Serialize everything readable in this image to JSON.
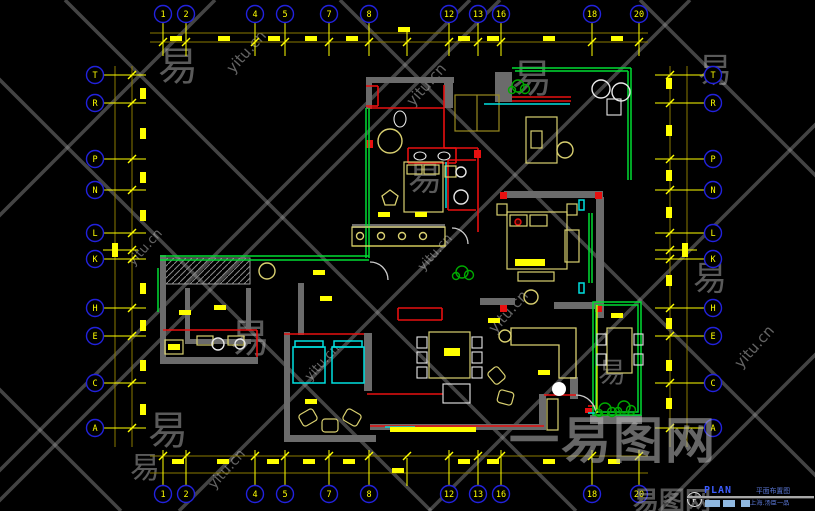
{
  "app": {
    "background": "#000000",
    "canvas": "CAD floor plan viewport"
  },
  "colors": {
    "grid_bubble": "#2222dd",
    "grid_label": "#ffff00",
    "dim_line": "#8a7a00",
    "tick": "#ffff00",
    "wall": "#6b6b6b",
    "red": "#e81010",
    "green": "#00dd33",
    "cyan": "#00e0e0",
    "furniture": "#d9d070",
    "white": "#e8e8e8",
    "watermark": "#9c9c9c",
    "title_accent": "#3c5cff",
    "title_cn": "#5b79d8"
  },
  "grid": {
    "top": {
      "cy": 14,
      "l1": 33,
      "l2": 42,
      "x0": 150,
      "x1": 648,
      "s0": 22,
      "s1": 56,
      "slash": 42,
      "labels": [
        [
          "1",
          163
        ],
        [
          "2",
          186
        ],
        [
          "4",
          255
        ],
        [
          "5",
          285
        ],
        [
          "7",
          329
        ],
        [
          "8",
          369
        ],
        [
          "12",
          449
        ],
        [
          "13",
          478
        ],
        [
          "16",
          501
        ],
        [
          "18",
          592
        ],
        [
          "20",
          639
        ]
      ],
      "extra": [
        407
      ],
      "dims": [
        [
          170,
          36
        ],
        [
          218,
          36
        ],
        [
          268,
          36
        ],
        [
          305,
          36
        ],
        [
          346,
          36
        ],
        [
          398,
          27
        ],
        [
          458,
          36
        ],
        [
          487,
          36
        ],
        [
          543,
          36
        ],
        [
          611,
          36
        ]
      ]
    },
    "bottom": {
      "cy": 494,
      "l1": 456,
      "l2": 473,
      "x0": 150,
      "x1": 648,
      "s0": 450,
      "s1": 486,
      "slash": 456,
      "labels": [
        [
          "1",
          163
        ],
        [
          "2",
          186
        ],
        [
          "4",
          255
        ],
        [
          "5",
          285
        ],
        [
          "7",
          329
        ],
        [
          "8",
          369
        ],
        [
          "12",
          449
        ],
        [
          "13",
          478
        ],
        [
          "16",
          501
        ],
        [
          "18",
          592
        ],
        [
          "20",
          639
        ]
      ],
      "extra": [
        407
      ],
      "dims": [
        [
          172,
          459
        ],
        [
          217,
          459
        ],
        [
          267,
          459
        ],
        [
          303,
          459
        ],
        [
          343,
          459
        ],
        [
          392,
          468
        ],
        [
          458,
          459
        ],
        [
          487,
          459
        ],
        [
          543,
          459
        ],
        [
          608,
          459
        ]
      ]
    },
    "left": {
      "cx": 95,
      "l1": 115,
      "l2": 132,
      "y0": 66,
      "y1": 447,
      "s0": 103,
      "s1": 146,
      "slash": 132,
      "labels": [
        [
          "T",
          75
        ],
        [
          "R",
          103
        ],
        [
          "P",
          159
        ],
        [
          "N",
          190
        ],
        [
          "L",
          233
        ],
        [
          "K",
          259
        ],
        [
          "H",
          308
        ],
        [
          "E",
          336
        ],
        [
          "C",
          383
        ],
        [
          "A",
          428
        ]
      ],
      "extra": [
        250
      ],
      "dims": [
        [
          140,
          88
        ],
        [
          140,
          128
        ],
        [
          140,
          172
        ],
        [
          140,
          210
        ],
        [
          112,
          243,
          14
        ],
        [
          140,
          283
        ],
        [
          140,
          320
        ],
        [
          140,
          360
        ],
        [
          140,
          404
        ]
      ]
    },
    "right": {
      "cx": 713,
      "l1": 670,
      "l2": 687,
      "y0": 66,
      "y1": 447,
      "s0": 655,
      "s1": 705,
      "slash": 670,
      "labels": [
        [
          "T",
          75
        ],
        [
          "R",
          103
        ],
        [
          "P",
          159
        ],
        [
          "N",
          190
        ],
        [
          "L",
          233
        ],
        [
          "K",
          259
        ],
        [
          "H",
          308
        ],
        [
          "E",
          336
        ],
        [
          "C",
          383
        ],
        [
          "A",
          428
        ]
      ],
      "extra": [
        250
      ],
      "dims": [
        [
          666,
          78
        ],
        [
          666,
          125
        ],
        [
          666,
          170
        ],
        [
          666,
          207
        ],
        [
          682,
          243,
          14
        ],
        [
          666,
          275
        ],
        [
          666,
          318
        ],
        [
          666,
          360
        ],
        [
          666,
          398
        ]
      ]
    }
  },
  "plan": {
    "hatch": [
      165,
      258,
      85,
      26
    ],
    "walls": [
      [
        366,
        77,
        88,
        6
      ],
      [
        366,
        77,
        6,
        32
      ],
      [
        444,
        77,
        9,
        31
      ],
      [
        495,
        72,
        17,
        30
      ],
      [
        480,
        298,
        35,
        7
      ],
      [
        504,
        191,
        99,
        7
      ],
      [
        596,
        197,
        8,
        121
      ],
      [
        554,
        302,
        47,
        7
      ],
      [
        160,
        255,
        6,
        108
      ],
      [
        160,
        357,
        98,
        7
      ],
      [
        298,
        283,
        6,
        52
      ],
      [
        284,
        332,
        6,
        110
      ],
      [
        284,
        435,
        92,
        7
      ],
      [
        364,
        333,
        8,
        58
      ],
      [
        370,
        424,
        176,
        6
      ],
      [
        539,
        394,
        7,
        36
      ],
      [
        570,
        377,
        8,
        22
      ],
      [
        590,
        415,
        52,
        9
      ],
      [
        185,
        288,
        5,
        56
      ],
      [
        185,
        339,
        66,
        5
      ],
      [
        246,
        288,
        5,
        42
      ],
      [
        352,
        224,
        93,
        4
      ]
    ],
    "red_lines": [
      [
        368,
        108,
        444,
        108
      ],
      [
        444,
        85,
        444,
        148
      ],
      [
        444,
        148,
        478,
        148
      ],
      [
        478,
        148,
        478,
        232
      ],
      [
        408,
        148,
        456,
        148
      ],
      [
        408,
        148,
        408,
        163
      ],
      [
        456,
        148,
        456,
        163
      ],
      [
        408,
        163,
        456,
        163
      ],
      [
        512,
        97,
        571,
        97
      ],
      [
        512,
        101,
        571,
        101
      ],
      [
        366,
        86,
        378,
        86
      ],
      [
        378,
        86,
        378,
        106
      ],
      [
        366,
        106,
        378,
        106
      ],
      [
        448,
        160,
        476,
        160
      ],
      [
        448,
        160,
        448,
        210
      ],
      [
        448,
        210,
        476,
        210
      ],
      [
        163,
        330,
        257,
        330
      ],
      [
        257,
        330,
        257,
        357
      ],
      [
        284,
        334,
        364,
        334
      ],
      [
        398,
        308,
        442,
        308
      ],
      [
        398,
        320,
        442,
        320
      ],
      [
        398,
        308,
        398,
        320
      ],
      [
        442,
        308,
        442,
        320
      ],
      [
        367,
        394,
        443,
        394
      ],
      [
        370,
        426,
        544,
        426
      ],
      [
        544,
        395,
        576,
        395
      ],
      [
        588,
        406,
        596,
        406
      ]
    ],
    "red_rects": [
      [
        500,
        192,
        7,
        7
      ],
      [
        595,
        192,
        7,
        7
      ],
      [
        500,
        305,
        7,
        7
      ],
      [
        595,
        305,
        7,
        7
      ],
      [
        585,
        408,
        7,
        5
      ],
      [
        366,
        140,
        7,
        8
      ],
      [
        474,
        150,
        7,
        8
      ]
    ],
    "red_dot": [
      518,
      222,
      3
    ],
    "green_lines": [
      [
        160,
        256,
        369,
        256
      ],
      [
        160,
        260,
        369,
        260
      ],
      [
        366,
        108,
        366,
        258
      ],
      [
        369,
        108,
        369,
        258
      ],
      [
        512,
        68,
        631,
        68
      ],
      [
        515,
        71,
        628,
        71
      ],
      [
        631,
        68,
        631,
        180
      ],
      [
        628,
        71,
        628,
        180
      ],
      [
        589,
        213,
        589,
        283
      ],
      [
        592,
        213,
        592,
        283
      ],
      [
        158,
        268,
        158,
        312
      ]
    ],
    "green_rects": [
      [
        593,
        302,
        48,
        113
      ],
      [
        596,
        305,
        42,
        107
      ]
    ],
    "plants": [
      [
        518,
        86
      ],
      [
        462,
        272
      ],
      [
        605,
        409
      ],
      [
        624,
        407
      ]
    ],
    "cyan_lines": [
      [
        484,
        104,
        570,
        104
      ],
      [
        385,
        427,
        415,
        427
      ],
      [
        446,
        162,
        446,
        208
      ],
      [
        588,
        413,
        596,
        413
      ]
    ],
    "cyan_rects": [
      [
        293,
        347,
        32,
        36
      ],
      [
        332,
        347,
        32,
        36
      ],
      [
        295,
        341,
        28,
        6
      ],
      [
        334,
        341,
        28,
        6
      ],
      [
        579,
        200,
        5,
        10
      ],
      [
        579,
        283,
        5,
        10
      ]
    ],
    "yellow_lines": [
      [
        597,
        305,
        597,
        413
      ],
      [
        352,
        246,
        445,
        246
      ]
    ],
    "olive_rects": [
      [
        455,
        95,
        44,
        36
      ]
    ],
    "olive_lines": [
      [
        477,
        95,
        477,
        131
      ]
    ],
    "y_stroke_rects": [
      [
        404,
        162,
        39,
        50
      ],
      [
        407,
        165,
        15,
        9
      ],
      [
        424,
        165,
        15,
        9
      ],
      [
        445,
        166,
        11,
        11
      ],
      [
        507,
        212,
        60,
        57
      ],
      [
        510,
        215,
        17,
        11
      ],
      [
        530,
        215,
        17,
        11
      ],
      [
        518,
        272,
        36,
        9
      ],
      [
        497,
        204,
        10,
        11
      ],
      [
        567,
        204,
        10,
        11
      ],
      [
        565,
        230,
        14,
        32
      ],
      [
        352,
        227,
        93,
        19
      ],
      [
        526,
        117,
        31,
        46
      ],
      [
        531,
        131,
        11,
        17
      ],
      [
        429,
        332,
        41,
        46
      ],
      [
        607,
        328,
        25,
        45
      ],
      [
        197,
        336,
        16,
        9
      ],
      [
        228,
        336,
        16,
        9
      ],
      [
        547,
        399,
        11,
        31
      ],
      [
        165,
        340,
        18,
        14
      ]
    ],
    "y_fill_rects": [
      [
        390,
        427,
        86,
        5
      ],
      [
        168,
        344,
        12,
        6
      ],
      [
        444,
        348,
        16,
        8
      ],
      [
        515,
        259,
        30,
        7
      ]
    ],
    "w_stroke_rects": [
      [
        607,
        99,
        14,
        16
      ],
      [
        443,
        384,
        27,
        19
      ],
      [
        417,
        337,
        10,
        11
      ],
      [
        417,
        352,
        10,
        11
      ],
      [
        417,
        367,
        10,
        11
      ],
      [
        472,
        337,
        10,
        11
      ],
      [
        472,
        352,
        10,
        11
      ],
      [
        472,
        367,
        10,
        11
      ],
      [
        597,
        334,
        9,
        11
      ],
      [
        597,
        354,
        9,
        11
      ],
      [
        634,
        334,
        9,
        11
      ],
      [
        634,
        354,
        9,
        11
      ]
    ],
    "circles_y": [
      [
        390,
        141,
        12
      ],
      [
        267,
        271,
        8
      ],
      [
        531,
        297,
        7
      ],
      [
        505,
        336,
        6
      ],
      [
        360,
        236,
        3.5
      ],
      [
        381,
        236,
        3.5
      ],
      [
        402,
        236,
        3.5
      ],
      [
        423,
        236,
        3.5
      ],
      [
        565,
        150,
        8
      ]
    ],
    "circles_w": [
      [
        601,
        89,
        9
      ],
      [
        621,
        92,
        9
      ],
      [
        461,
        172,
        5
      ],
      [
        461,
        197,
        7
      ],
      [
        218,
        344,
        6
      ],
      [
        240,
        344,
        5
      ]
    ],
    "circle_fill_w": [
      559,
      389,
      7
    ],
    "ellipses_w": [
      [
        420,
        156,
        6,
        4
      ],
      [
        444,
        156,
        6,
        4
      ],
      [
        400,
        119,
        6,
        8
      ]
    ],
    "rot_rects": [
      [
        300,
        411,
        16,
        13,
        -30
      ],
      [
        322,
        419,
        16,
        13,
        0
      ],
      [
        344,
        411,
        16,
        13,
        30
      ],
      [
        490,
        368,
        13,
        15,
        -40
      ],
      [
        499,
        390,
        13,
        15,
        -75
      ]
    ],
    "paths": [
      {
        "d": "M511,328 h65 v50 h-17 v-33 h-48 z",
        "s": "#d9d070"
      },
      {
        "d": "M390,190 l8,6 -3,9 -10,0 -3,-9 z",
        "s": "#d9d070"
      },
      {
        "d": "M452,228 a16,16 0 0 1 16,16",
        "s": "#cccccc"
      },
      {
        "d": "M370,262 a18,18 0 0 1 18,18",
        "s": "#cccccc"
      },
      {
        "d": "M576,395 a20,20 0 0 1 20,20",
        "s": "#cccccc"
      }
    ],
    "dims": [
      [
        313,
        270
      ],
      [
        179,
        310
      ],
      [
        378,
        212
      ],
      [
        415,
        212
      ],
      [
        305,
        399
      ],
      [
        538,
        370
      ],
      [
        488,
        318
      ],
      [
        214,
        305
      ],
      [
        611,
        313
      ],
      [
        320,
        296
      ]
    ]
  },
  "watermarks": {
    "lattice_sum": [
      215,
      470,
      500,
      690,
      940,
      1170
    ],
    "lattice_diff": [
      -390,
      -80,
      65,
      340,
      640
    ],
    "texts": [
      {
        "t": "yitu.cn",
        "x": 250,
        "y": 55,
        "r": -48,
        "s": 15
      },
      {
        "t": "yitu.cn",
        "x": 430,
        "y": 88,
        "r": -48,
        "s": 15
      },
      {
        "t": "yitu.cn",
        "x": 148,
        "y": 250,
        "r": -48,
        "s": 13
      },
      {
        "t": "yitu.cn",
        "x": 512,
        "y": 315,
        "r": -48,
        "s": 15
      },
      {
        "t": "yitu.cn",
        "x": 325,
        "y": 365,
        "r": -48,
        "s": 13
      },
      {
        "t": "yitu.cn",
        "x": 230,
        "y": 472,
        "r": -48,
        "s": 14
      },
      {
        "t": "yitu.cn",
        "x": 758,
        "y": 350,
        "r": -48,
        "s": 15
      },
      {
        "t": "yitu.cn",
        "x": 438,
        "y": 255,
        "r": -48,
        "s": 13
      }
    ],
    "yi": [
      [
        178,
        80,
        40
      ],
      [
        532,
        92,
        40
      ],
      [
        425,
        190,
        34
      ],
      [
        250,
        352,
        40
      ],
      [
        168,
        444,
        40
      ],
      [
        715,
        82,
        34
      ],
      [
        710,
        290,
        34
      ],
      [
        145,
        478,
        30
      ],
      [
        612,
        382,
        28
      ]
    ],
    "big": {
      "t": "一易图网",
      "x": 613,
      "y": 458,
      "s": 50
    },
    "small": {
      "t": "易图网",
      "x": 672,
      "y": 510,
      "s": 26
    }
  },
  "titleblock": {
    "symbol": "P",
    "label": "PLAN",
    "title_cn": "平面布置图",
    "subtitle_cn": "上海.汤臣一品",
    "swatches": [
      [
        705,
        15
      ],
      [
        723,
        12
      ],
      [
        741,
        9
      ]
    ]
  }
}
